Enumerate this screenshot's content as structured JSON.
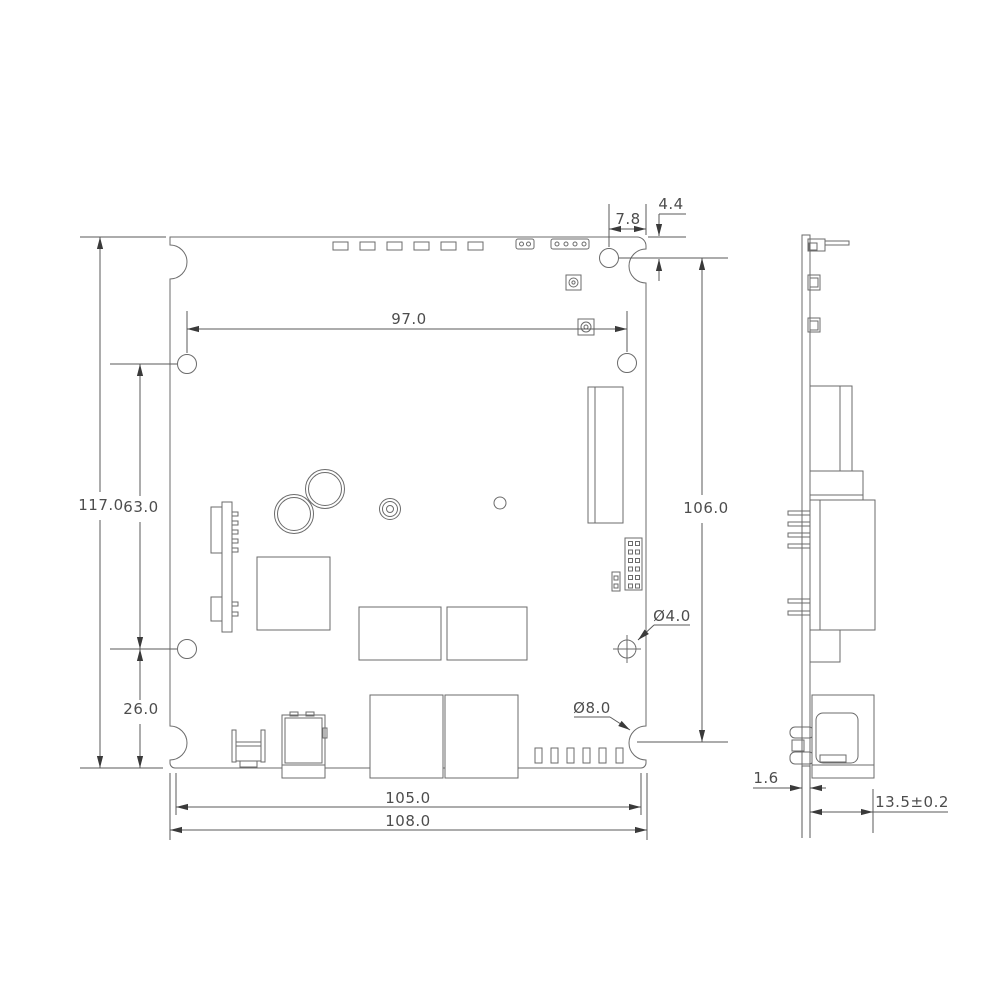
{
  "dimensions": {
    "board_height": "117.0",
    "left_hole_span": "63.0",
    "bottom_left_hole_offset": "26.0",
    "top_hole_span": "97.0",
    "corner_hole_offset_x": "7.8",
    "corner_hole_offset_y": "4.4",
    "right_vertical_span": "106.0",
    "mounting_hole_diameter": "Ø4.0",
    "edge_notch_diameter": "Ø8.0",
    "bottom_span": "105.0",
    "board_width": "108.0",
    "pcb_thickness": "1.6",
    "connector_height": "13.5±0.2"
  }
}
